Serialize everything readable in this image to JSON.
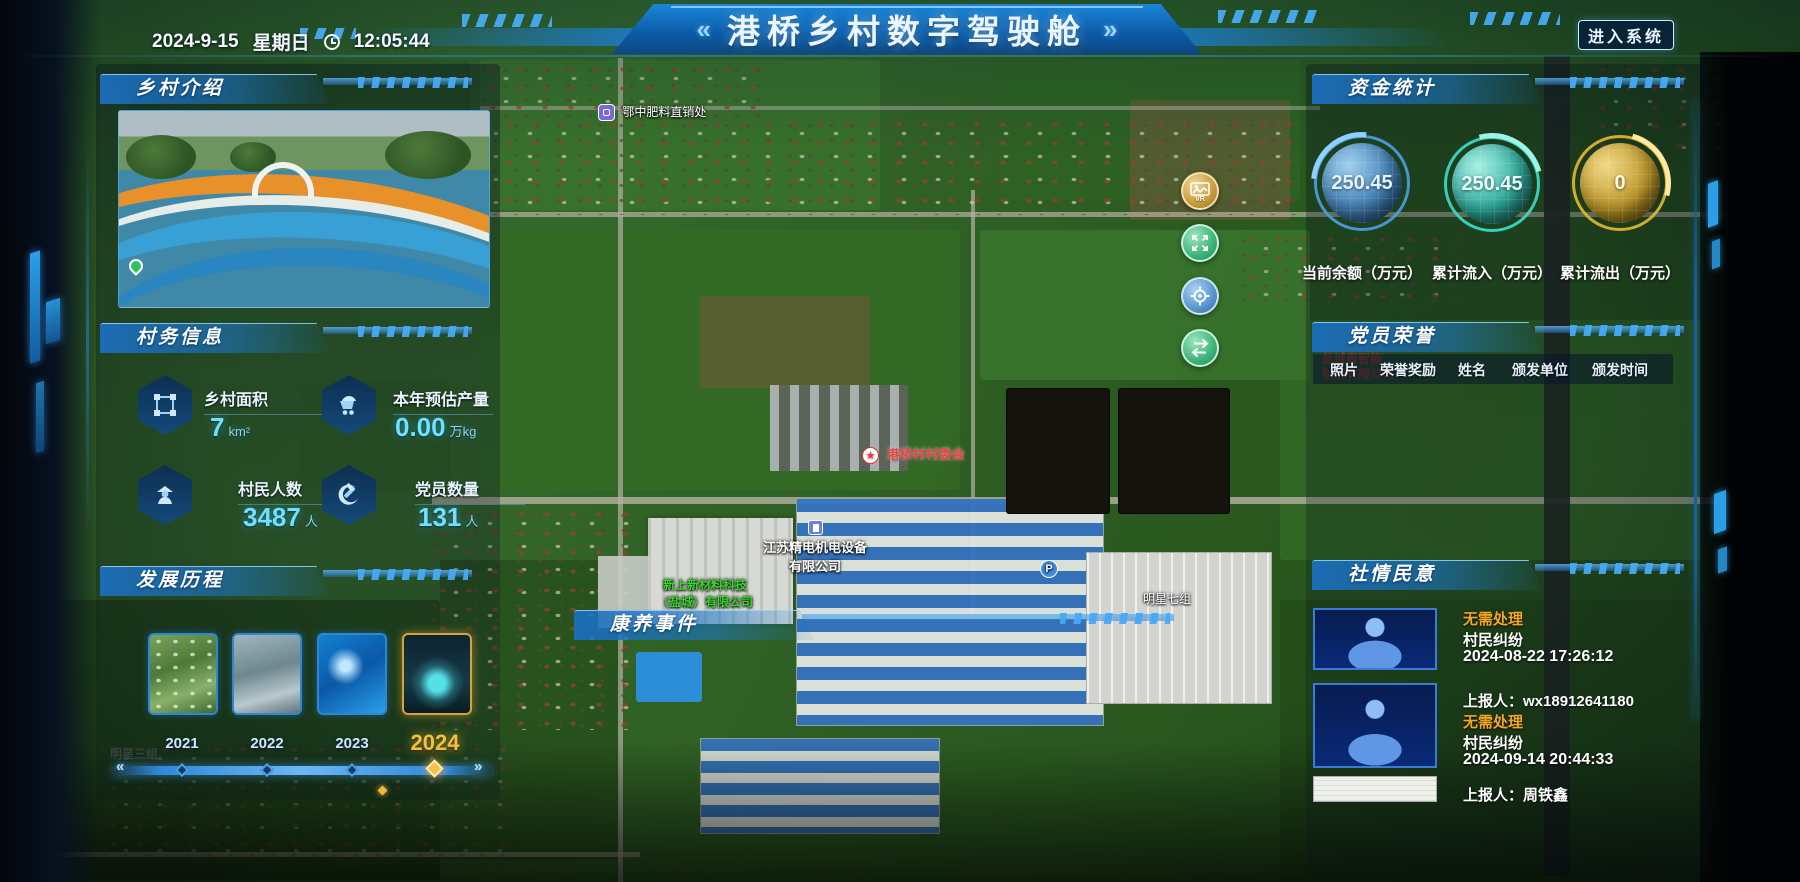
{
  "header": {
    "date": "2024-9-15",
    "weekday": "星期日",
    "time": "12:05:44",
    "chevron_left": "«",
    "title": "港桥乡村数字驾驶舱",
    "chevron_right": "»",
    "enter_button": "进入系统"
  },
  "panels": {
    "village_intro": {
      "title": "乡村介绍"
    },
    "village_info": {
      "title": "村务信息",
      "stats": [
        {
          "icon": "area-icon",
          "label": "乡村面积",
          "value": "7",
          "unit": "km²"
        },
        {
          "icon": "cart-icon",
          "label": "本年预估产量",
          "value": "0.00",
          "unit": "万kg"
        },
        {
          "icon": "villager-icon",
          "label": "村民人数",
          "value": "3487",
          "unit": "人"
        },
        {
          "icon": "party-icon",
          "label": "党员数量",
          "value": "131",
          "unit": "人"
        }
      ]
    },
    "development": {
      "title": "发展历程",
      "years": [
        "2021",
        "2022",
        "2023",
        "2024"
      ],
      "selected_year": "2024"
    },
    "health_events": {
      "title": "康养事件"
    },
    "funds": {
      "title": "资金统计",
      "gauges": [
        {
          "value": "250.45",
          "label": "当前余额（万元）",
          "color": "#4aa0e8"
        },
        {
          "value": "250.45",
          "label": "累计流入（万元）",
          "color": "#38e0cc"
        },
        {
          "value": "0",
          "label": "累计流出（万元）",
          "color": "#e8b830"
        }
      ]
    },
    "party_honor": {
      "title": "党员荣誉",
      "columns": [
        "照片",
        "荣誉奖励",
        "姓名",
        "颁发单位",
        "颁发时间"
      ]
    },
    "public_opinion": {
      "title": "社情民意",
      "items": [
        {
          "status": "无需处理",
          "type": "村民纠纷",
          "time": "2024-08-22 17:26:12",
          "reporter": "上报人：wx18912641180"
        },
        {
          "status": "无需处理",
          "type": "村民纠纷",
          "time": "2024-09-14 20:44:33",
          "reporter": "上报人：周铁鑫"
        }
      ]
    }
  },
  "map": {
    "vr_label": "VR",
    "parking_label": "P",
    "labels": [
      {
        "line1": "鄂中肥料直销处"
      },
      {
        "line1": "港桥村村委会"
      },
      {
        "line1": "江苏精电机电设备",
        "line2": "有限公司"
      },
      {
        "line1": "新上新材料科技",
        "line2": "（盐城）有限公司"
      },
      {
        "line1": "明星七组"
      },
      {
        "line1": "明星三组"
      },
      {
        "line1": "盐城春智能",
        "line2": "制造有限公司"
      }
    ],
    "star_glyph": "★"
  },
  "colors": {
    "accent": "#1e86d8",
    "gauge_balance": "#4aa0e8",
    "gauge_inflow": "#38e0cc",
    "gauge_outflow": "#e8b830",
    "status_warning": "#f5a623",
    "highlight_gold": "#f0c040"
  }
}
